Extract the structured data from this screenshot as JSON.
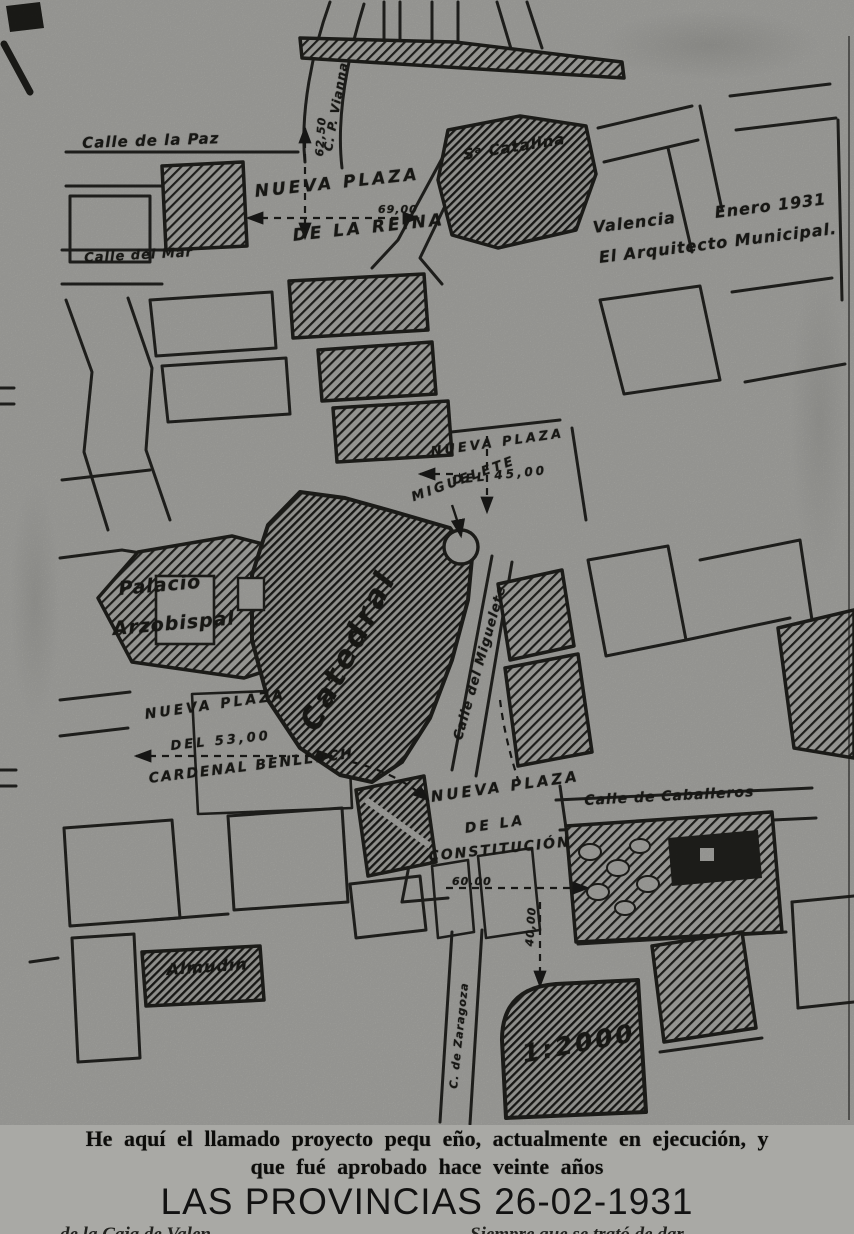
{
  "map": {
    "labels": {
      "calle_paz": "Calle de la Paz",
      "vianna": "C. P. Vianna",
      "reina_1": "NUEVA PLAZA",
      "reina_2": "DE LA REINA",
      "dim_62": "62,50",
      "dim_69": "69,00",
      "catalina": "Sᵃ Catalina",
      "calle_mar": "Calle del Mar",
      "firma_lugar": "Valencia      Enero 1931",
      "firma_autor": "El Arquitecto Municipal.",
      "levante_1": "NUEVA PLAZA",
      "levante_2": "DEL 45,00",
      "miguelete": "MIGUELETE",
      "palacio_1": "Palacio",
      "palacio_2": "Arzobispal",
      "catedral": "Catedral",
      "calle_miguelete": "Calle del Miguelete",
      "benlloch_1": "NUEVA PLAZA",
      "benlloch_2": "DEL 53,00",
      "benlloch_3": "CARDENAL BENLLOCH",
      "constitucion_1": "NUEVA PLAZA",
      "constitucion_2": "DE LA",
      "constitucion_3": "CONSTITUCIÓN",
      "dim_60": "60,00",
      "dim_40": "40,00",
      "calle_caballeros": "Calle de Caballeros",
      "almudin": "Almudín",
      "calle_zaragoza": "C. de Zaragoza",
      "escala": "1:2000"
    }
  },
  "caption": {
    "line1": "He aquí el llamado proyecto pequ eño, actualmente en ejecución, y",
    "line2": "que fué aprobado hace veinte años",
    "overlay": "LAS PROVINCIAS 26-02-1931",
    "fragment_left": "de la Caja de Valen",
    "fragment_right": "Siempre que se trató de dar"
  },
  "colors": {
    "paper": "#a9a9a5",
    "ink": "#1f1f1c"
  }
}
